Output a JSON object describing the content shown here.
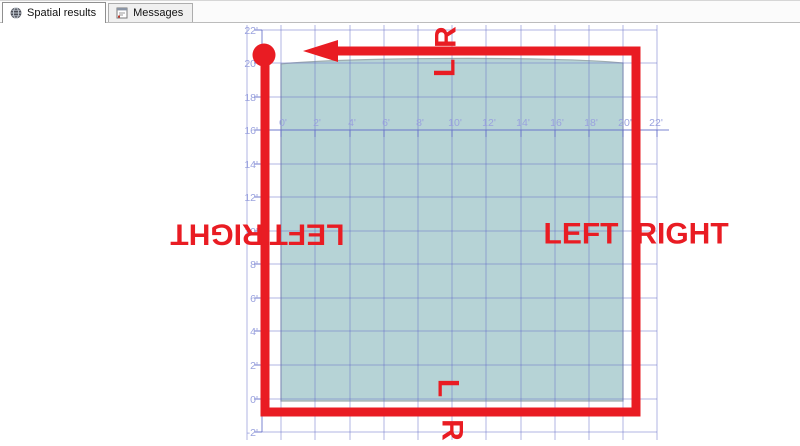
{
  "tabs": [
    {
      "label": "Spatial results",
      "active": true
    },
    {
      "label": "Messages",
      "active": false
    }
  ],
  "chart_data": {
    "type": "spatial-polygon",
    "x_tick_labels": [
      "0'",
      "2'",
      "4'",
      "6'",
      "8'",
      "10'",
      "12'",
      "14'",
      "16'",
      "18'",
      "20'",
      "22'"
    ],
    "y_tick_labels": [
      "22'",
      "20'",
      "18'",
      "16'",
      "14'",
      "12'",
      "10'",
      "8'",
      "6'",
      "4'",
      "2'",
      "0'",
      "-2'"
    ],
    "x_range": [
      "0'",
      "22'"
    ],
    "y_range": [
      "-2'",
      "22'"
    ],
    "grid": true,
    "polygon": {
      "description": "teal filled square region spanning 0' to 20' horizontally and 0' to about 20' vertically, top edge slightly arched",
      "fill": "#b6d3d6"
    },
    "annotations": {
      "shape": "thick red square path with round start dot at top-left corner and arrow pointing left along the top edge",
      "left_outside": "RIGHT",
      "left_inside": "LEFT",
      "right_inside": "LEFT",
      "right_outside": "RIGHT",
      "top_outside": "R",
      "top_inside": "L",
      "bottom_inside": "L",
      "bottom_outside": "R",
      "color": "#e91c23"
    }
  },
  "colors": {
    "annotation_red": "#e91c23",
    "polygon_fill": "#b6d3d6",
    "polygon_border": "#9fadaf",
    "grid_line": "rgba(100,110,200,0.5)",
    "ruler_line": "rgba(100,110,200,0.85)",
    "axis_text": "#9aa2de"
  }
}
